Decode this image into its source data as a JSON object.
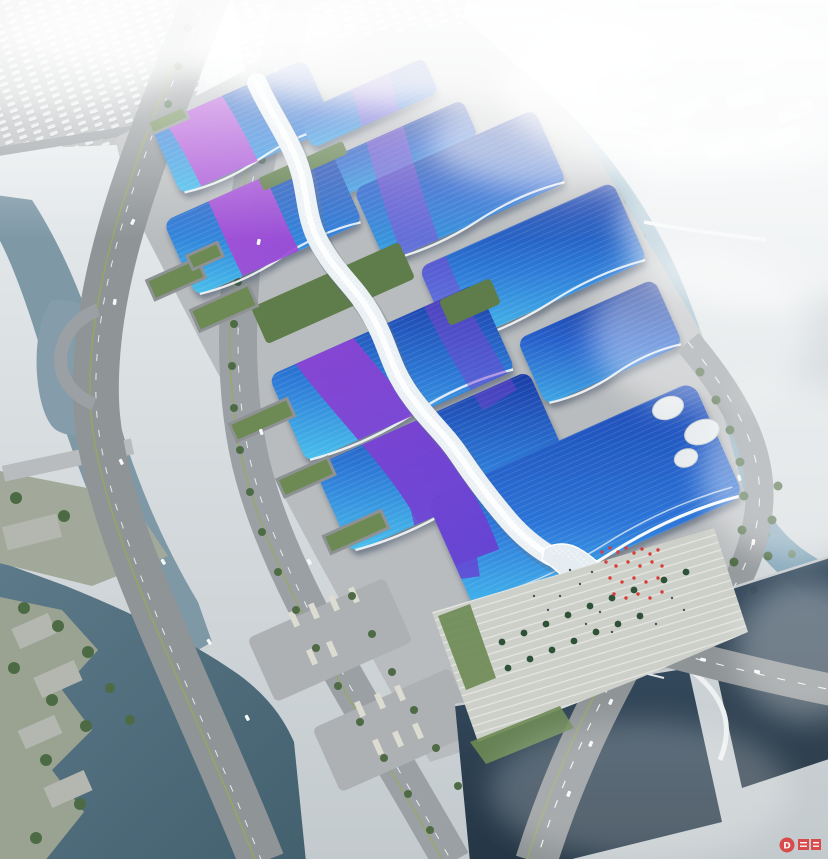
{
  "meta": {
    "title": "Aerial rendering of exhibition and convention center complex",
    "type": "architectural-visualization-birdseye"
  },
  "scene": {
    "description": "Bird's-eye rendering of a huge exhibition complex: paired blue exhibition halls with sweeping purple ribbon roofs flank a white serpentine central concourse that ends in a wave-shaped entrance hall; surrounded by concrete aprons, tree-lined expressways, canals and dark lakes, with a fog-shrouded white city and a winding river beyond.",
    "landmarks": {
      "halls": "blue exhibition halls with purple ribbon roofs",
      "spine": "white serpentine central concourse",
      "entrance": "wave-roof south entrance hall with flag-decorated plaza",
      "west": "elevated expressway, canal, terraced waterfront park and lakes",
      "east": "winding river with pedestrian bridge and foggy city blocks",
      "south": "road intersection over dark ponds with arched footbridge"
    }
  },
  "palette": {
    "hall_cyan": "#49c2ec",
    "hall_blue": "#2e7cd8",
    "hall_navy": "#1a3aa6",
    "ribbon_magenta": "#c356d8",
    "ribbon_purple": "#9044d4",
    "ribbon_violet": "#6a3fd2",
    "spine_white": "#eaf0f4",
    "ground": "#b9bcbe",
    "plaza": "#cdcfc9",
    "road": "#8f9496",
    "canal": "#7e98a6",
    "lake": "#54707f",
    "pond_dark": "#2c4254",
    "river_light": "#a8c4d2",
    "river_deep": "#7fa2b6",
    "tree_green": "#4e6b46",
    "green_roof": "#6d8a54",
    "fog_white": "#ffffff",
    "flag_red": "#d83c36",
    "watermark_red": "#dd3434"
  },
  "watermark": {
    "symbol": "D"
  }
}
